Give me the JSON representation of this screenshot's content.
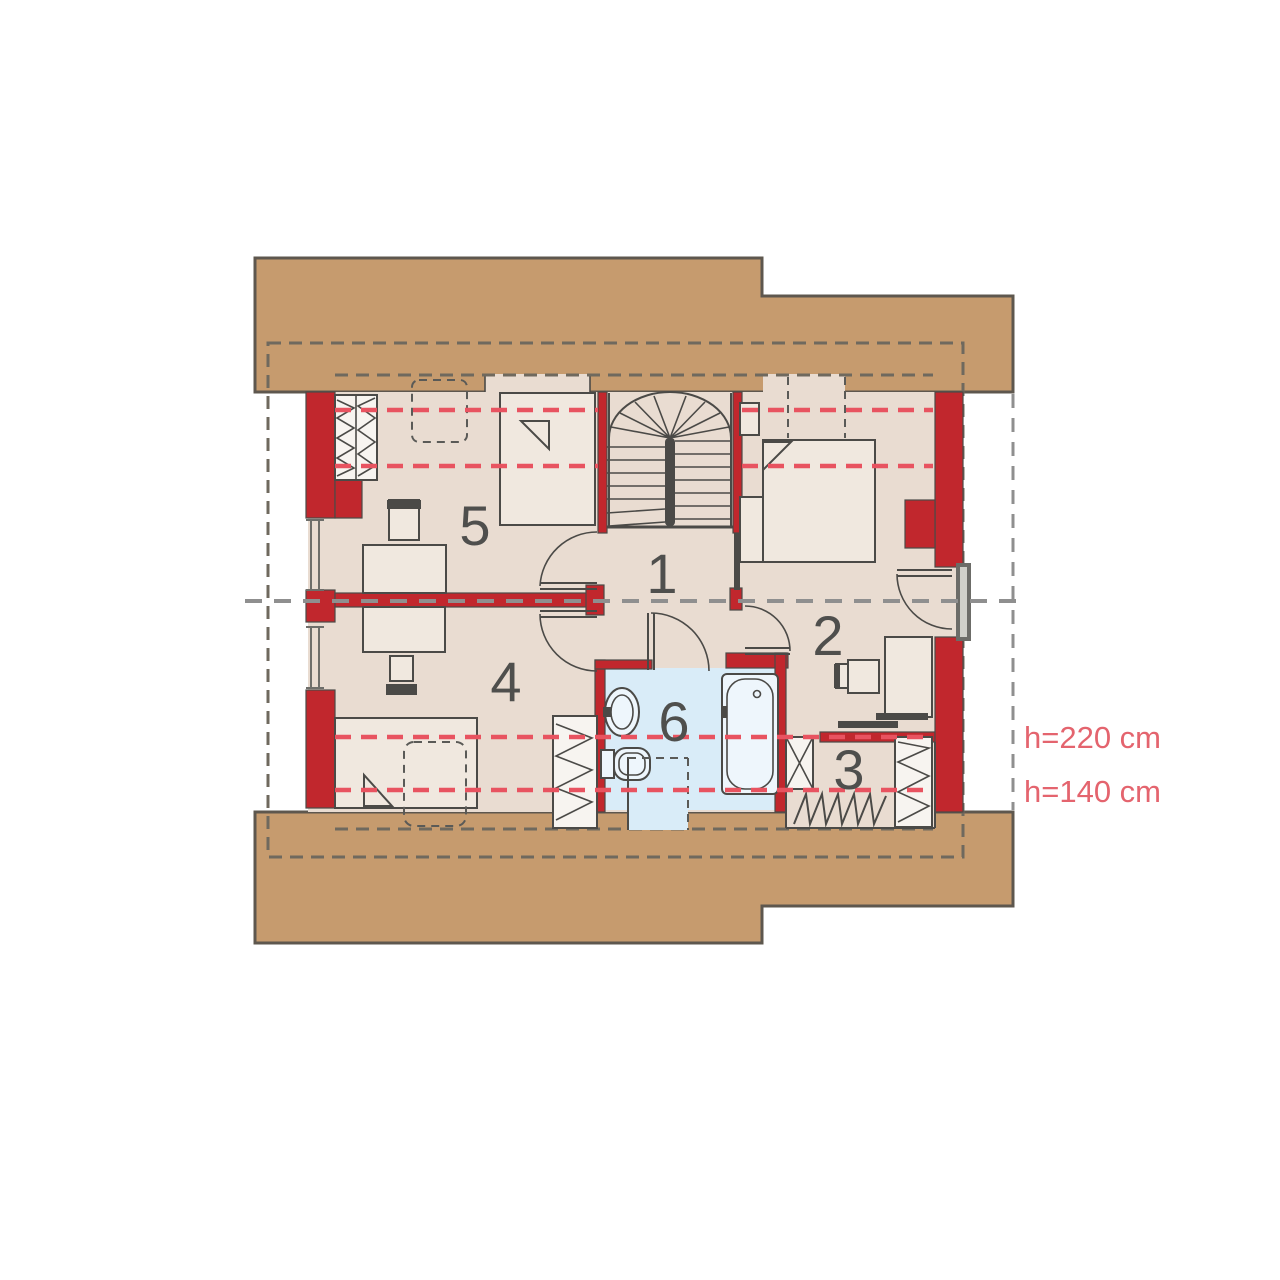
{
  "plan": {
    "type": "attic-floor-plan",
    "rooms": [
      {
        "number": "1"
      },
      {
        "number": "2"
      },
      {
        "number": "3"
      },
      {
        "number": "4"
      },
      {
        "number": "5"
      },
      {
        "number": "6"
      }
    ],
    "height_labels": [
      {
        "text": "h=220 cm"
      },
      {
        "text": "h=140 cm"
      }
    ]
  },
  "colors": {
    "canvas": "#ffffff",
    "roof": "#c69b6e",
    "roof-border": "#5e574e",
    "floor": "#e9dcd1",
    "furniture": "#f0e8df",
    "white-box": "#f7f4f0",
    "bath-floor": "#d9ecf8",
    "wall-red": "#c1272d",
    "wall-dark": "#4b4a47",
    "dash-dark": "#6f695e",
    "dash-gray": "#8f8f8f",
    "dash-red": "#e85360",
    "label": "#4f4f4d",
    "hlabel": "#e4646e"
  }
}
